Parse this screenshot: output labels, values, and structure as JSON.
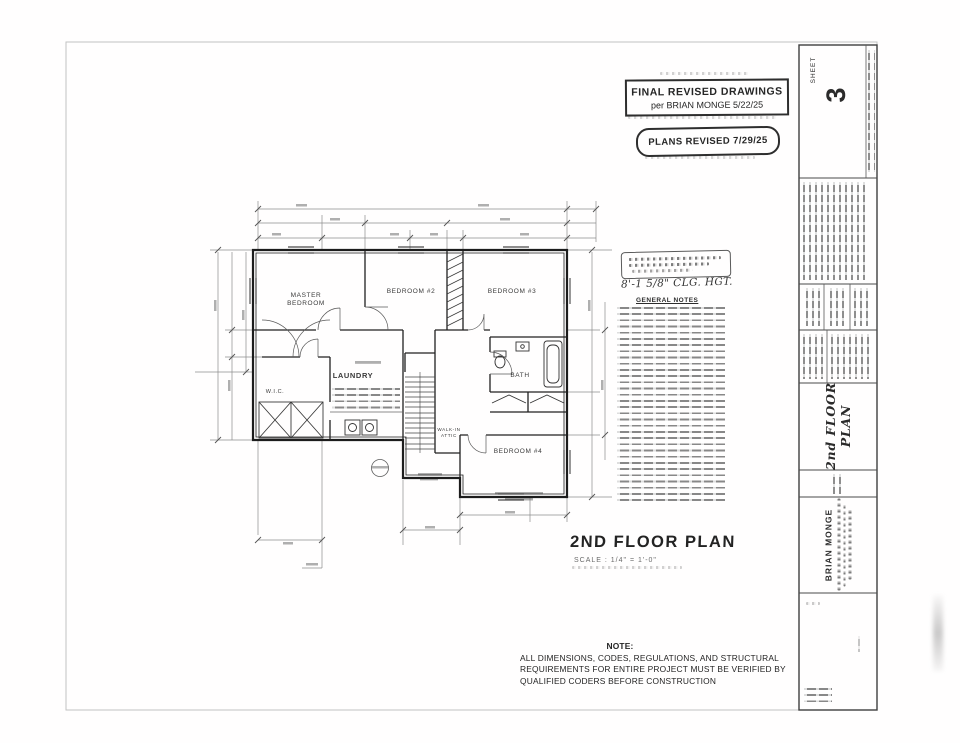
{
  "stamps": {
    "final_line1": "FINAL REVISED DRAWINGS",
    "final_line2": "per BRIAN MONGE 5/22/25",
    "plans_revised": "PLANS REVISED 7/29/25"
  },
  "plan": {
    "title": "2ND FLOOR PLAN",
    "scale": "SCALE : 1/4\" = 1'-0\"",
    "ceiling_note": "8'-1 5/8\" CLG. HGT.",
    "rooms": {
      "master": "MASTER\nBEDROOM",
      "bedroom2": "BEDROOM #2",
      "bedroom3": "BEDROOM #3",
      "bath": "BATH",
      "bedroom4": "BEDROOM #4",
      "laundry": "LAUNDRY",
      "wic": "W.I.C.",
      "attic": "WALK-IN\nATTIC"
    }
  },
  "notes": {
    "header": "GENERAL NOTES"
  },
  "bottom_note": {
    "label": "NOTE:",
    "line1": "ALL DIMENSIONS, CODES, REGULATIONS, AND STRUCTURAL",
    "line2": "REQUIREMENTS FOR ENTIRE PROJECT MUST BE VERIFIED BY",
    "line3": "QUALIFIED CODERS BEFORE CONSTRUCTION"
  },
  "titleblock": {
    "sheet_label": "SHEET",
    "sheet_number": "3",
    "drawing_title": "2nd FLOOR\nPLAN",
    "client": "BRIAN MONGE"
  }
}
